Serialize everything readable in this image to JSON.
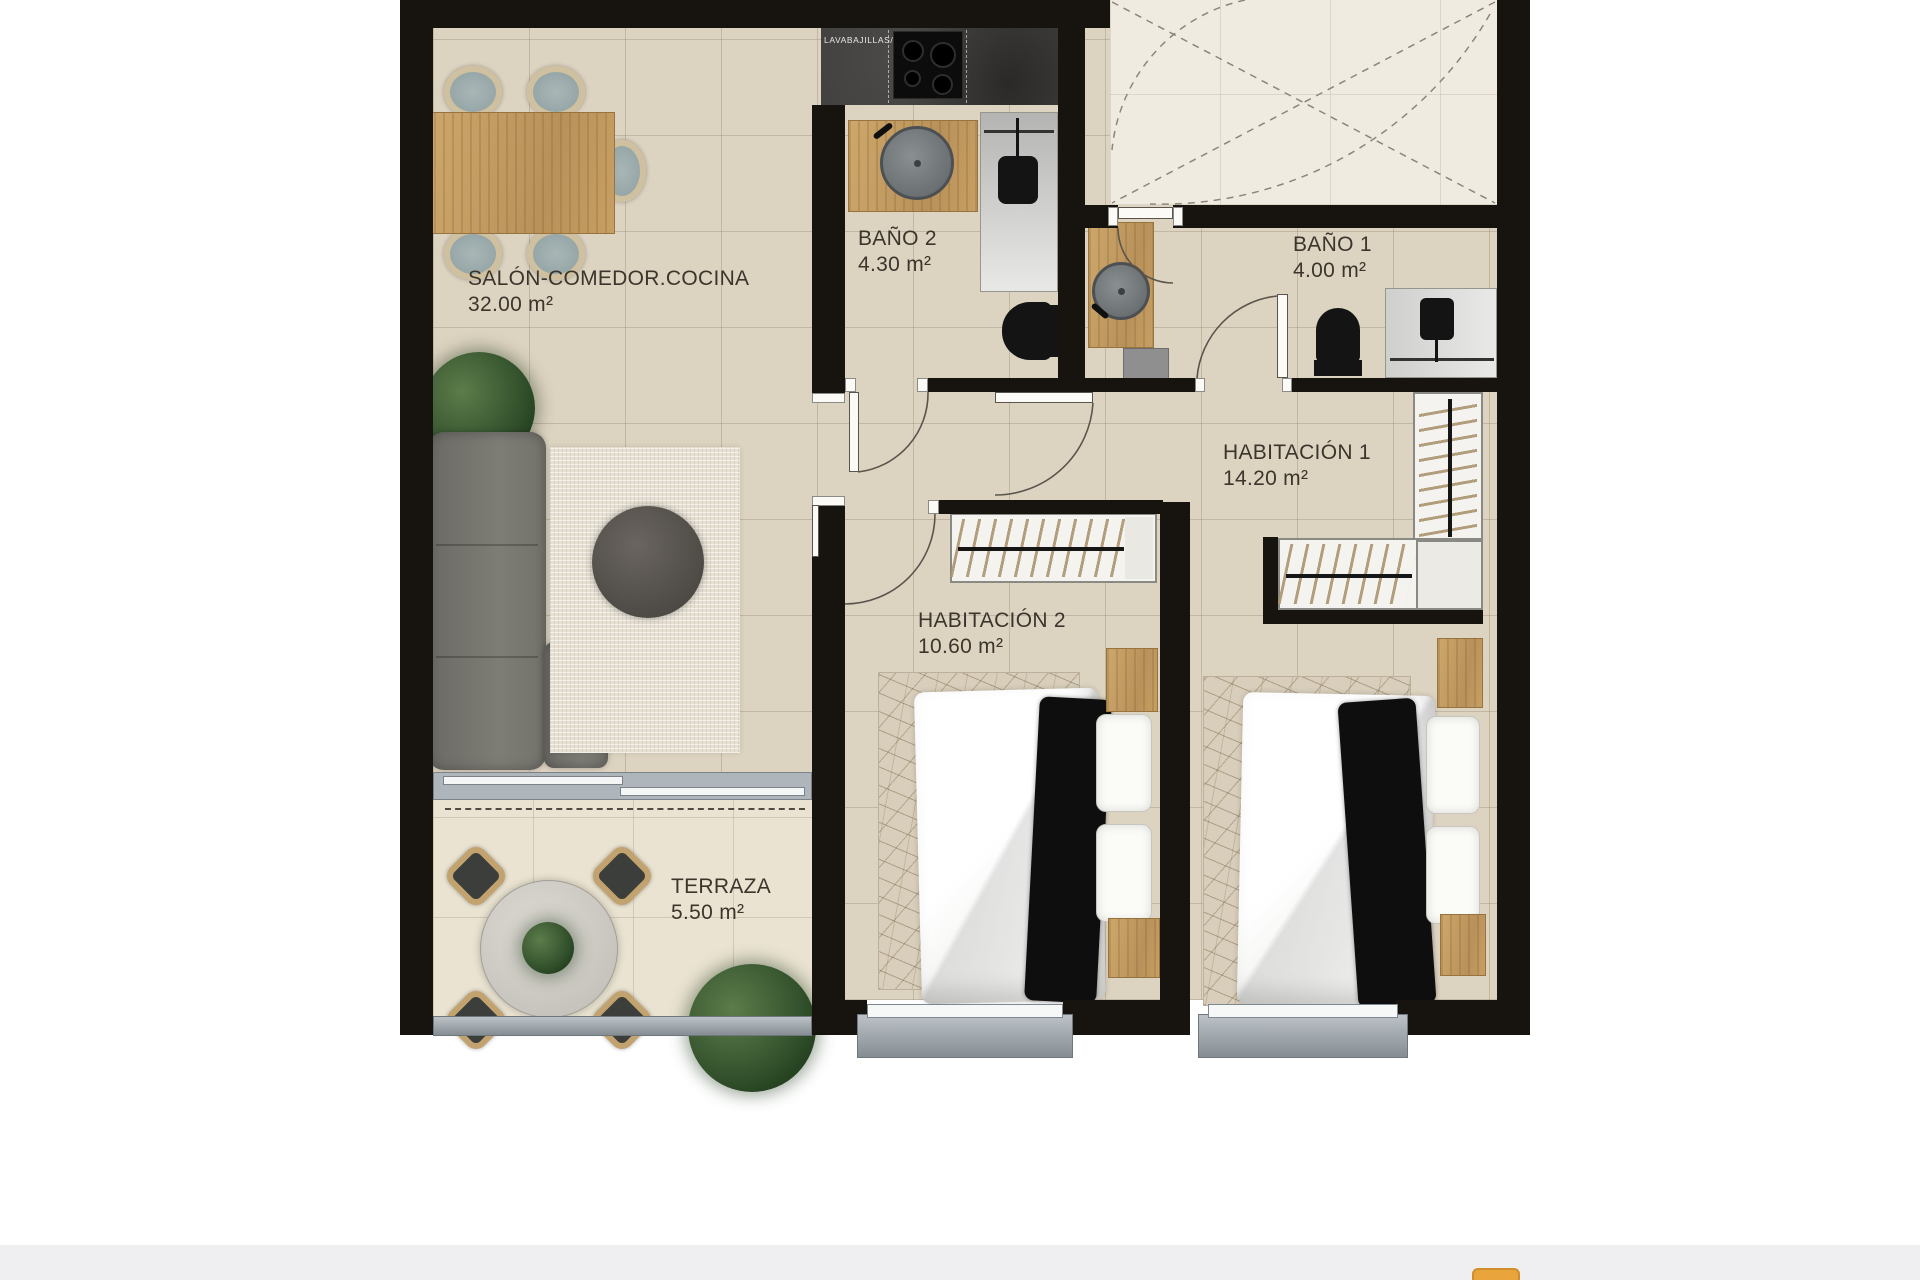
{
  "plan": {
    "title": "floor-plan",
    "rooms": [
      {
        "id": "salon",
        "name": "SALÓN-COMEDOR.COCINA",
        "area": "32.00 m²"
      },
      {
        "id": "bano2",
        "name": "BAÑO 2",
        "area": "4.30 m²"
      },
      {
        "id": "bano1",
        "name": "BAÑO 1",
        "area": "4.00 m²"
      },
      {
        "id": "habitacion1",
        "name": "HABITACIÓN 1",
        "area": "14.20 m²"
      },
      {
        "id": "habitacion2",
        "name": "HABITACIÓN 2",
        "area": "10.60 m²"
      },
      {
        "id": "terraza",
        "name": "TERRAZA",
        "area": "5.50 m²"
      }
    ],
    "annotations": {
      "dishwasher": "LAVABAJILLAS/"
    },
    "colors": {
      "wall": "#17140f",
      "interior_floor": "#ddd3c1",
      "terrace_floor": "#eae3d1",
      "stairwell_floor": "#f0ebe1",
      "wood": "#c2995f",
      "counter": "#403f3d",
      "sofa": "#75746e",
      "label_text": "#3b352c",
      "window_frame": "#98a1a8",
      "accent_orange": "#e9a43c",
      "footer_bar": "#efeff1"
    }
  }
}
